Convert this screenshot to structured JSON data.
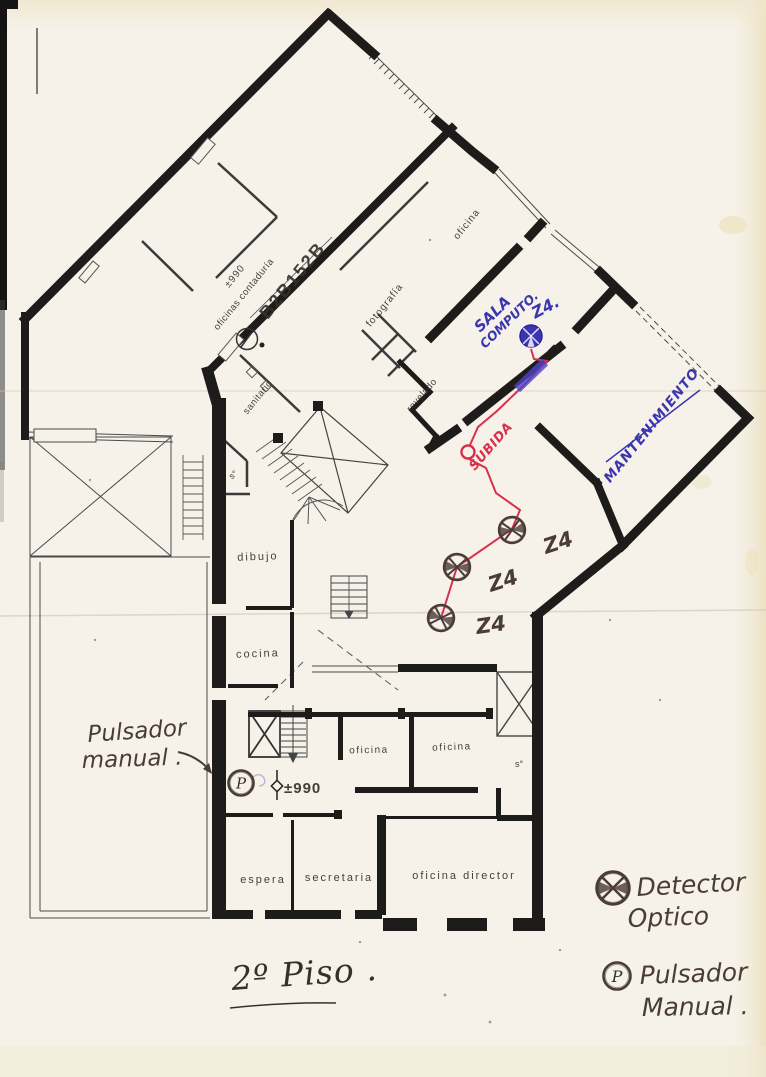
{
  "document": {
    "type": "scanned floor plan",
    "sheet": "fire detection layout"
  },
  "colors": {
    "paper": "#f6f2e9",
    "wall": "#1e1c1a",
    "ink_blue": "#3b35b0",
    "ink_red": "#d92f4c",
    "pencil": "#4b3b38"
  },
  "title": {
    "text": "2º Piso ."
  },
  "floorplan": {
    "plan_code": {
      "text": "B2B152B"
    },
    "levels": {
      "top": {
        "text": "±990"
      },
      "bottom": {
        "text": "±990"
      }
    },
    "room_labels": [
      {
        "id": "oficinas-contaduria",
        "text": "oficinas contaduría",
        "x": 246,
        "y": 296,
        "rot": -51,
        "size": 9.5,
        "ls": 0.5
      },
      {
        "id": "fotografia",
        "text": "fotografía",
        "x": 387,
        "y": 307,
        "rot": -51,
        "size": 10,
        "ls": 1
      },
      {
        "id": "oficina-top",
        "text": "oficina",
        "x": 469,
        "y": 226,
        "rot": -51,
        "size": 10,
        "ls": 1
      },
      {
        "id": "sanitario",
        "text": "sanitario",
        "x": 260,
        "y": 399,
        "rot": -51,
        "size": 9.5,
        "ls": 0.5
      },
      {
        "id": "revelado",
        "text": "revelado",
        "x": 424,
        "y": 397,
        "rot": -49,
        "size": 9.5,
        "ls": 0.5
      },
      {
        "id": "dibujo",
        "text": "dibujo",
        "x": 258,
        "y": 560,
        "rot": -2,
        "size": 11,
        "ls": 2
      },
      {
        "id": "cocina",
        "text": "cocina",
        "x": 258,
        "y": 657,
        "rot": -2,
        "size": 11,
        "ls": 2
      },
      {
        "id": "oficina-left",
        "text": "oficina",
        "x": 369,
        "y": 753,
        "rot": -1,
        "size": 10,
        "ls": 1.5
      },
      {
        "id": "oficina-right",
        "text": "oficina",
        "x": 452,
        "y": 750,
        "rot": -2,
        "size": 10,
        "ls": 1.5
      },
      {
        "id": "s-room-lower",
        "text": "s°",
        "x": 519,
        "y": 767,
        "rot": 0,
        "size": 9,
        "ls": 0
      },
      {
        "id": "s-room-mid",
        "text": "s°",
        "x": 235,
        "y": 477,
        "rot": -40,
        "size": 9,
        "ls": 0
      },
      {
        "id": "espera",
        "text": "espera",
        "x": 263,
        "y": 883,
        "rot": 0,
        "size": 11,
        "ls": 2
      },
      {
        "id": "secretaria",
        "text": "secretaria",
        "x": 339,
        "y": 881,
        "rot": 0,
        "size": 11,
        "ls": 2
      },
      {
        "id": "oficina-director",
        "text": "oficina  director",
        "x": 464,
        "y": 879,
        "rot": 0,
        "size": 11,
        "ls": 2
      }
    ]
  },
  "annotations": {
    "sala_computo": {
      "line1": "SALA",
      "line2": "COMPUTO."
    },
    "zone_blue": {
      "text": "Z4."
    },
    "mantenimiento": {
      "text": "MANTENIMIENTO"
    },
    "subida": {
      "text": "SUBIDA"
    },
    "pulsador_note": {
      "line1": "Pulsador",
      "line2": "manual ."
    },
    "zone_labels": [
      {
        "text": "Z4",
        "x": 546,
        "y": 554,
        "rot": -18
      },
      {
        "text": "Z4",
        "x": 491,
        "y": 592,
        "rot": -18
      },
      {
        "text": "Z4",
        "x": 477,
        "y": 634,
        "rot": -8
      }
    ]
  },
  "fire_system": {
    "detectors": [
      {
        "x": 512,
        "y": 530
      },
      {
        "x": 457,
        "y": 567
      },
      {
        "x": 441,
        "y": 618
      }
    ],
    "blue_detector": {
      "x": 531,
      "y": 336
    },
    "manual_button": {
      "symbol": "P",
      "x": 241,
      "y": 783
    },
    "red_line": {
      "points_a": "531,349 534,359 547,361 523,386 497,411 478,427 470,445",
      "points_b": "469,459 486,468 496,493 520,510 512,529 457,567 441,618"
    }
  },
  "legend": {
    "detector": {
      "line1": "Detector",
      "line2": "Optico"
    },
    "pulsador": {
      "line1": "Pulsador",
      "line2": "Manual .",
      "symbol": "P"
    }
  }
}
